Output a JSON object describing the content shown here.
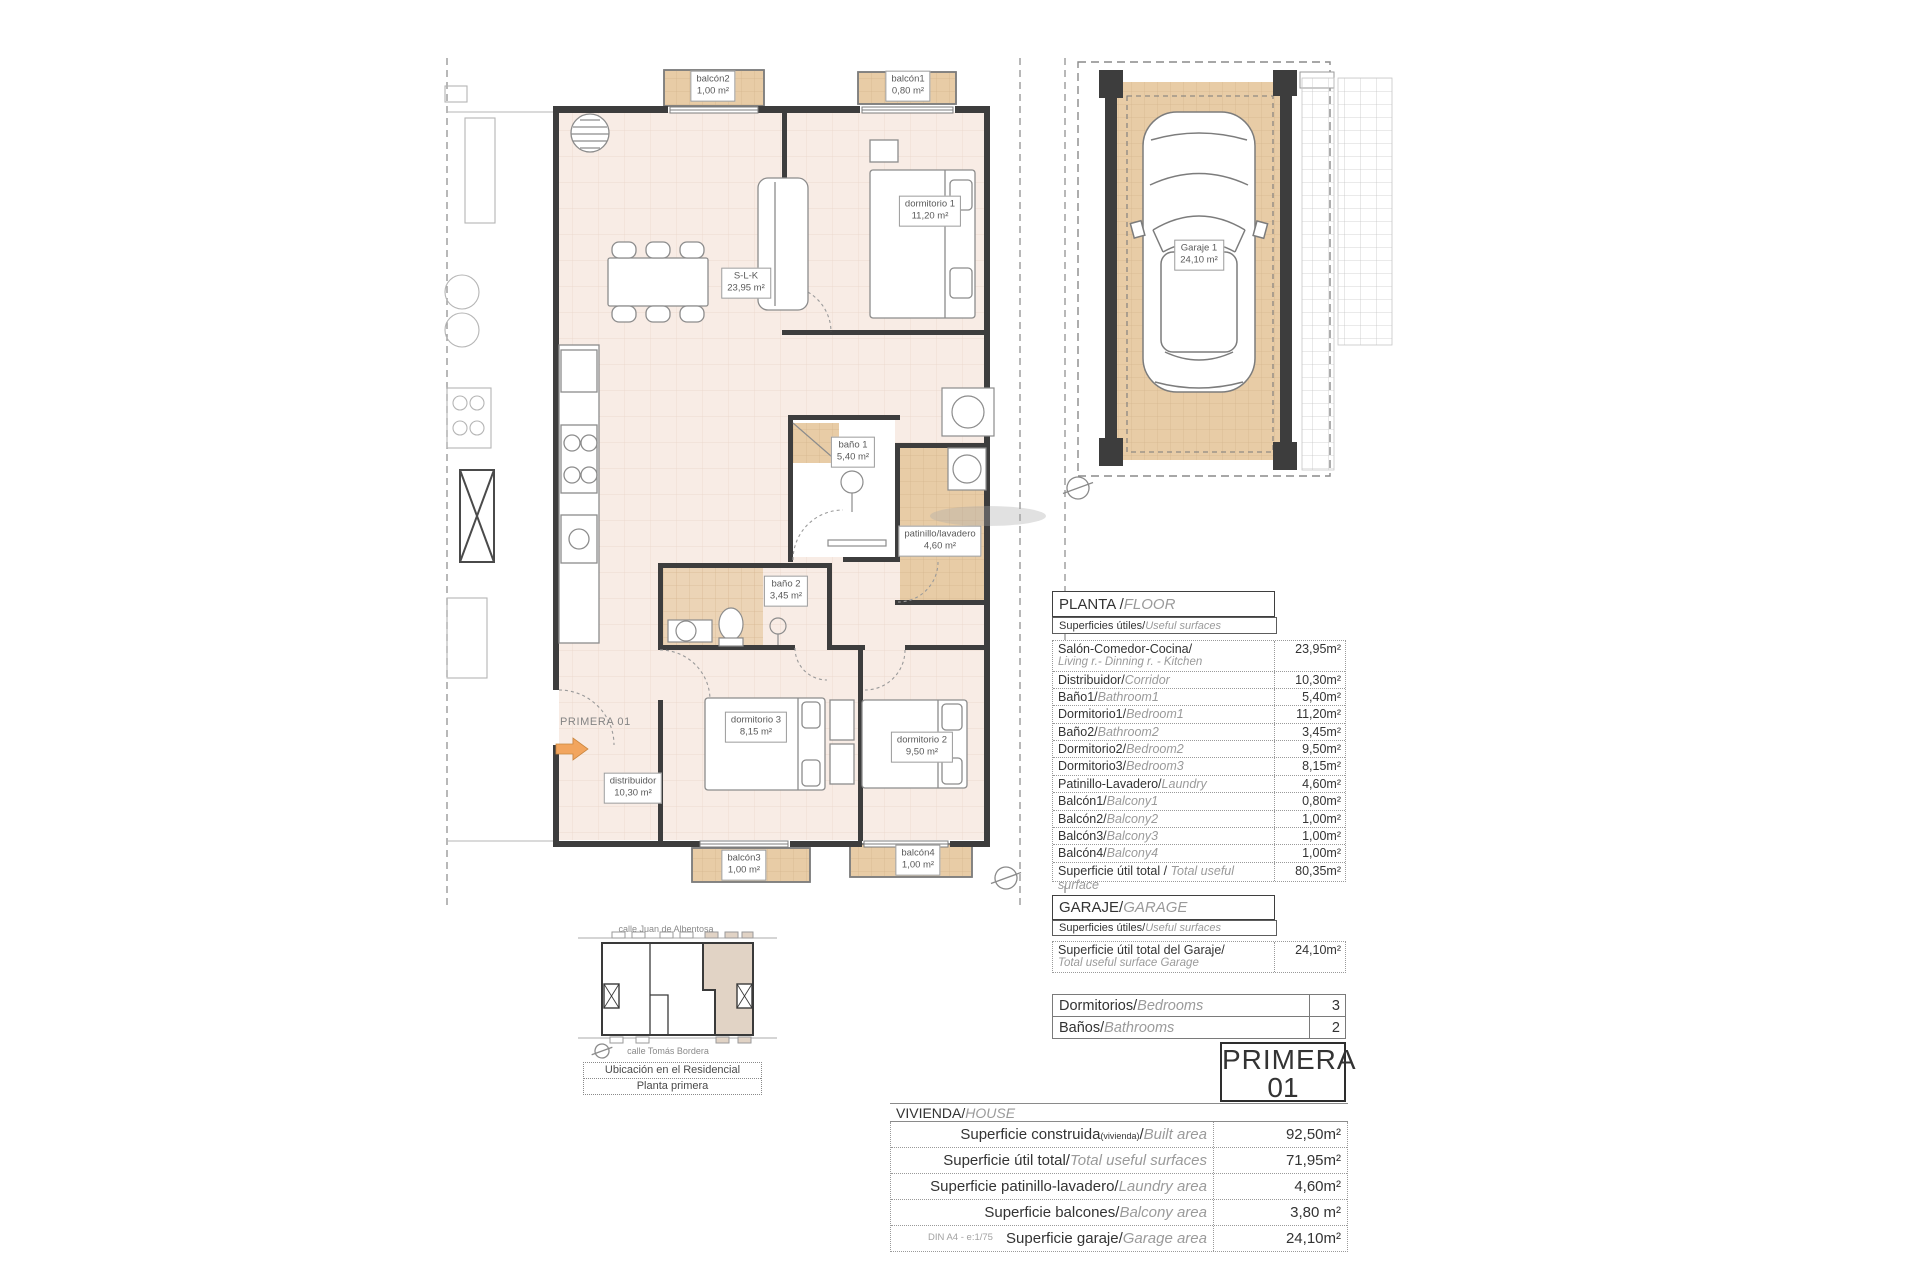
{
  "colors": {
    "floor": "#f8ece5",
    "tile": "#e8cca6",
    "wall": "#3d3d3d",
    "furniture": "#8c8c8c",
    "dash": "#999999",
    "arrow": "#f2a55e",
    "highlight": "#e1d3c5",
    "label-text": "#5a5a5a"
  },
  "plan": {
    "unit_marker": "PRIMERA 01",
    "rooms": [
      {
        "name": "balcón2",
        "area": "1,00 m²"
      },
      {
        "name": "balcón1",
        "area": "0,80 m²"
      },
      {
        "name": "S-L-K",
        "area": "23,95 m²"
      },
      {
        "name": "dormitorio 1",
        "area": "11,20 m²"
      },
      {
        "name": "baño 1",
        "area": "5,40 m²"
      },
      {
        "name": "patinillo/lavadero",
        "area": "4,60 m²"
      },
      {
        "name": "baño 2",
        "area": "3,45 m²"
      },
      {
        "name": "dormitorio 3",
        "area": "8,15 m²"
      },
      {
        "name": "dormitorio 2",
        "area": "9,50 m²"
      },
      {
        "name": "distribuidor",
        "area": "10,30 m²"
      },
      {
        "name": "balcón3",
        "area": "1,00 m²"
      },
      {
        "name": "balcón4",
        "area": "1,00 m²"
      }
    ],
    "garage_room": {
      "name": "Garaje 1",
      "area": "24,10 m²"
    }
  },
  "floor_section": {
    "title_es": "PLANTA / ",
    "title_en": "FLOOR",
    "sub_es": "Superficies útiles/",
    "sub_en": "Useful surfaces",
    "rows": [
      {
        "es": "Salón-Comedor-Cocina/",
        "en": "Living r.- Dinning r. - Kitchen",
        "value": "23,95m²"
      },
      {
        "es": "Distribuidor/",
        "en": "Corridor",
        "value": "10,30m²"
      },
      {
        "es": "Baño1/",
        "en": "Bathroom1",
        "value": "5,40m²"
      },
      {
        "es": "Dormitorio1/",
        "en": "Bedroom1",
        "value": "11,20m²"
      },
      {
        "es": "Baño2/",
        "en": "Bathroom2",
        "value": "3,45m²"
      },
      {
        "es": "Dormitorio2/",
        "en": "Bedroom2",
        "value": "9,50m²"
      },
      {
        "es": "Dormitorio3/",
        "en": "Bedroom3",
        "value": "8,15m²"
      },
      {
        "es": "Patinillo-Lavadero/",
        "en": "Laundry",
        "value": "4,60m²"
      },
      {
        "es": "Balcón1/",
        "en": "Balcony1",
        "value": "0,80m²"
      },
      {
        "es": "Balcón2/",
        "en": "Balcony2",
        "value": "1,00m²"
      },
      {
        "es": "Balcón3/",
        "en": "Balcony3",
        "value": "1,00m²"
      },
      {
        "es": "Balcón4/",
        "en": "Balcony4",
        "value": "1,00m²"
      }
    ],
    "total": {
      "es": "Superficie útil total / ",
      "en": "Total useful surface",
      "value": "80,35m²"
    }
  },
  "garage_section": {
    "title_es": "GARAJE/",
    "title_en": "GARAGE",
    "sub_es": "Superficies útiles/",
    "sub_en": "Useful surfaces",
    "row": {
      "es": "Superficie útil total del Garaje/",
      "en": "Total useful surface Garage",
      "value": "24,10m²"
    }
  },
  "counts": {
    "rows": [
      {
        "es": "Dormitorios/",
        "en": "Bedrooms",
        "value": "3"
      },
      {
        "es": "Baños/",
        "en": "Bathrooms",
        "value": "2"
      }
    ]
  },
  "unit_badge": {
    "line1": "PRIMERA",
    "line2": "01"
  },
  "house_section": {
    "title_es": "VIVIENDA/",
    "title_en": "HOUSE",
    "rows": [
      {
        "es": "Superficie construida",
        "sub": "(vivienda)",
        "slash": "/",
        "en": "Built area",
        "value": "92,50m²"
      },
      {
        "es": "Superficie útil total/",
        "en": "Total useful surfaces",
        "value": "71,95m²"
      },
      {
        "es": "Superficie patinillo-lavadero/",
        "en": "Laundry area",
        "value": "4,60m²"
      },
      {
        "es": "Superficie balcones/",
        "en": "Balcony area",
        "value": "3,80 m²"
      },
      {
        "es": "Superficie garaje/",
        "en": "Garage area",
        "value": "24,10m²"
      }
    ]
  },
  "location": {
    "street_top": "calle Juan de Albentosa",
    "street_bottom": "calle Tomás Bordera",
    "caption_line1": "Ubicación en el Residencial",
    "caption_line2": "Planta primera"
  },
  "footer_note": "DIN A4 - e:1/75"
}
